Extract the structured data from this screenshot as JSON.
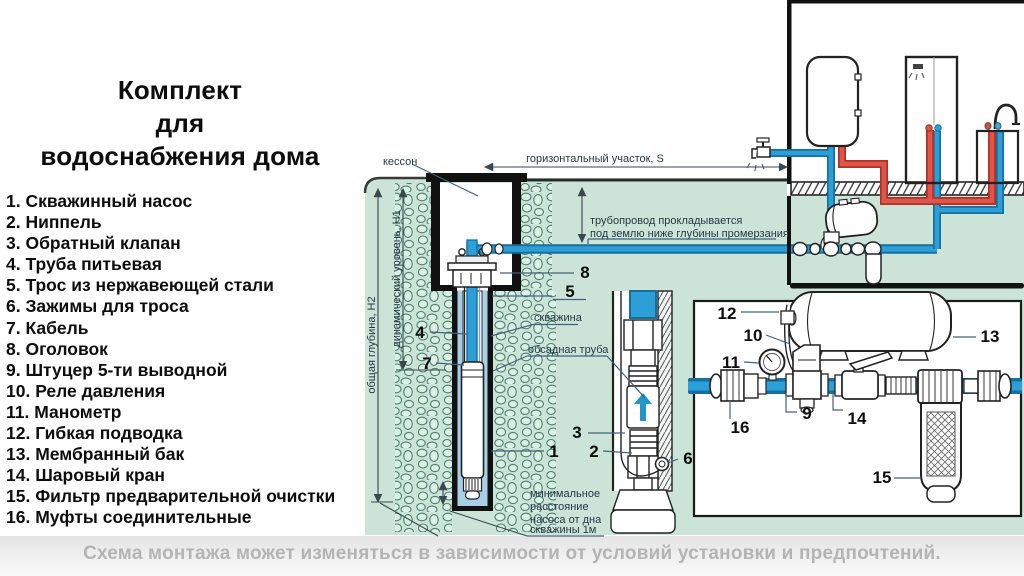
{
  "title": {
    "line1": "Комплект",
    "line2": "для",
    "line3": "водоснабжения дома"
  },
  "parts_list": [
    "1. Скважинный насос",
    "2. Ниппель",
    "3. Обратный клапан",
    "4. Труба питьевая",
    "5. Трос из нержавеющей стали",
    "6. Зажимы для троса",
    "7. Кабель",
    "8. Оголовок",
    "9. Штуцер 5-ти выводной",
    "10. Реле давления",
    "11. Манометр",
    "12. Гибкая подводка",
    "13. Мембранный бак",
    "14. Шаровый кран",
    "15. Фильтр предварительной очистки",
    "16. Муфты соединительные"
  ],
  "diagram": {
    "labels": {
      "kesson": "кессон",
      "horizontal_section": "горизонтальный участок, S",
      "pipe_note1": "трубопровод прокладывается",
      "pipe_note2": "под землю ниже глубины промерзания",
      "borehole": "скважина",
      "casing": "обсадная труба",
      "total_depth": "общая глубина, Н2",
      "dynamic_level": "динамический уровень, Н1",
      "min1": "минимальное",
      "min2": "расстояние",
      "min3": "насоса от дна",
      "min4": "скважины 1м"
    },
    "callouts": {
      "c1": "1",
      "c2": "2",
      "c3": "3",
      "c4": "4",
      "c5": "5",
      "c6": "6",
      "c7": "7",
      "c8": "8",
      "c9": "9",
      "c10": "10",
      "c11": "11",
      "c12": "12",
      "c13": "13",
      "c14": "14",
      "c15": "15",
      "c16": "16"
    }
  },
  "footer": {
    "caption": "Схема монтажа может изменяться в зависимости от условий установки и предпочтений."
  },
  "colors": {
    "ground_green": "#cbe4d7",
    "water_blue": "#a9cfe7",
    "pipe_blue": "#2d9fd8",
    "pipe_blue_dark": "#176f9e",
    "pipe_red": "#e0544a",
    "pipe_red_dark": "#ad3327",
    "caption_gray": "#b4b4b4"
  }
}
